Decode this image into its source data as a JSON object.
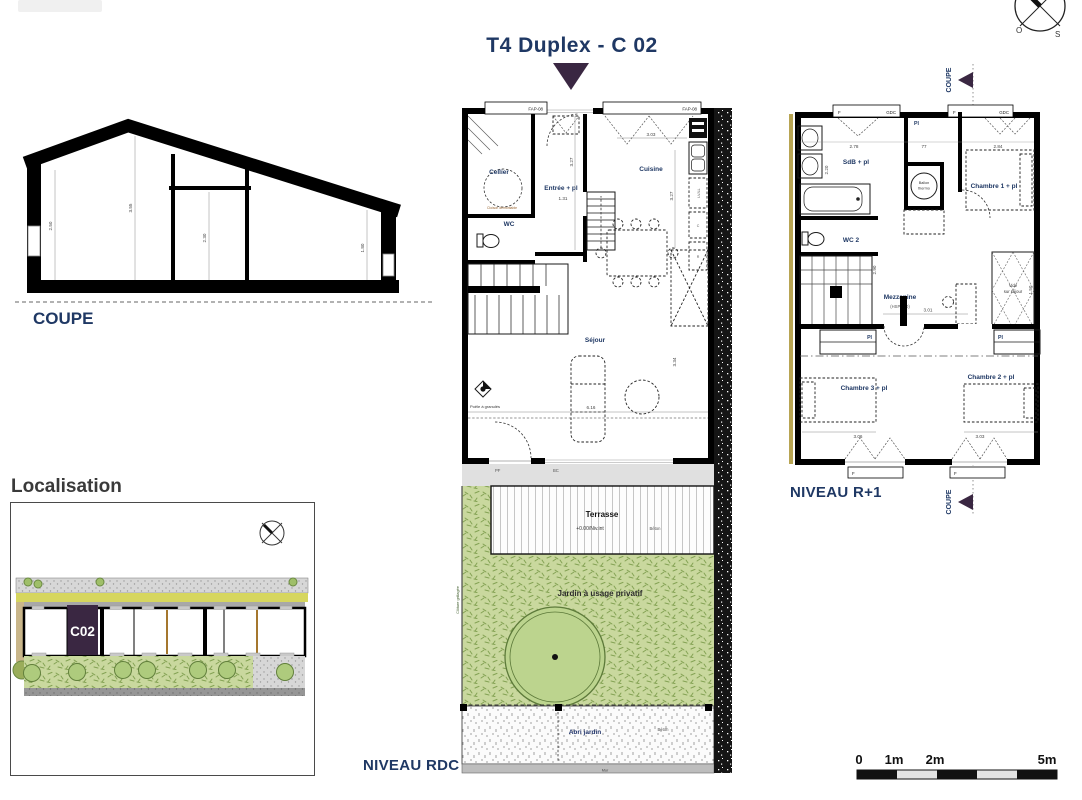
{
  "title": "T4 Duplex - C 02",
  "colors": {
    "navy": "#1f3864",
    "purple": "#3a2742",
    "garden_green": "#c9d89e",
    "road_yellow": "#d6d65e",
    "wall_black": "#000000"
  },
  "coupe": {
    "label": "COUPE",
    "d_left": "2.50",
    "d_peak": "3.55",
    "d_mid": "2.30",
    "d_right": "1.80"
  },
  "compass": {
    "west": "O",
    "south": "S"
  },
  "marker": {
    "label": "COUPE"
  },
  "rdc": {
    "level": "NIVEAU RDC",
    "fap": "FAP-08",
    "cellier": "Cellier",
    "cloison": "Cloison démontable",
    "entree": "Entrée + pl",
    "cuisine": "Cuisine",
    "wc": "WC",
    "sejour": "Séjour",
    "poele": "Poêle à granulés",
    "pf": "PF",
    "bc": "BC",
    "lv": "LV/LL",
    "c": "C",
    "r": "R",
    "d131": "1.31",
    "d327": "3.27",
    "d303": "3.03",
    "d334": "3.34",
    "d616": "6.16"
  },
  "garden": {
    "terrasse": "Terrasse",
    "niv": "+0.00/Niv.int",
    "beton": "Béton",
    "jardin": "Jardin à usage privatif",
    "cloture": "Clôture grillagée",
    "abri": "Abri jardin",
    "mur": "Mur"
  },
  "r1": {
    "level": "NIVEAU R+1",
    "f": "F",
    "gdc": "GDC",
    "sdb": "SdB + pl",
    "wc2": "WC 2",
    "pl": "Pl",
    "ballon1": "Ballon",
    "ballon2": "thermo",
    "ch1": "Chambre 1 + pl",
    "mezz": "Mezzanine",
    "hsp": "(HSP 230)",
    "vide1": "Vide",
    "vide2": "sur séjour",
    "ch3": "Chambre 3 + pl",
    "ch2": "Chambre 2 + pl",
    "d278": "2.78",
    "d77": "77",
    "d284": "2.84",
    "d220": "2.20",
    "d290": "2.90",
    "d301": "3.01",
    "d150": "1.50",
    "d306": "3.06",
    "d303": "3.03"
  },
  "localisation": {
    "title": "Localisation",
    "unit": "C02"
  },
  "scalebar": {
    "l0": "0",
    "l1": "1m",
    "l2": "2m",
    "l5": "5m"
  }
}
